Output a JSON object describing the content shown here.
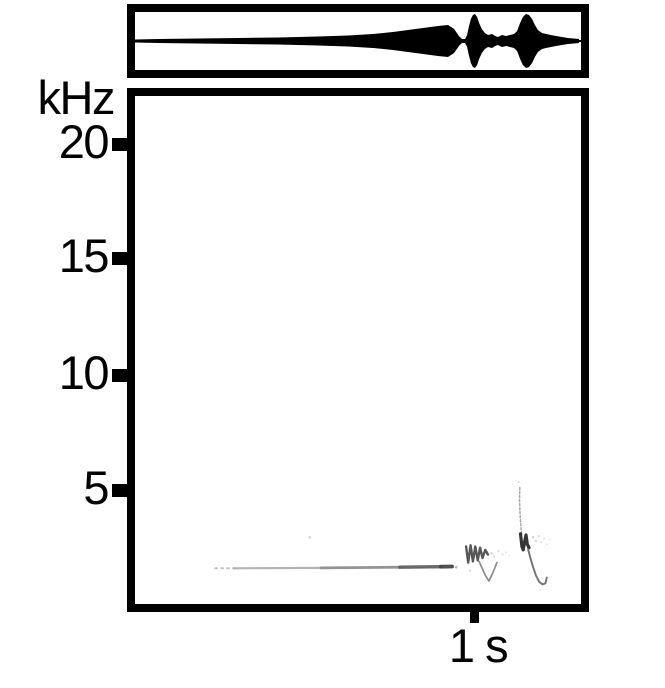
{
  "figure": {
    "description": "Sound figure: oscillogram (top) over spectrogram (bottom)",
    "background_color": "#ffffff",
    "frame_color": "#000000"
  },
  "axes": {
    "y_unit_label": "kHz",
    "y_tick_labels": [
      "20",
      "15",
      "10",
      "5"
    ],
    "x_tick_label": "1 s"
  },
  "chart_data": [
    {
      "type": "area",
      "title": "oscillogram (waveform amplitude envelope)",
      "x_unit": "s",
      "x_range": [
        0,
        1.3
      ],
      "t": [
        0,
        0.073,
        0.19,
        0.307,
        0.424,
        0.541,
        0.629,
        0.702,
        0.76,
        0.804,
        0.848,
        0.892,
        0.921,
        0.939,
        0.953,
        0.962,
        0.971,
        0.977,
        0.982,
        0.988,
        0.994,
        1.0,
        1.006,
        1.012,
        1.02,
        1.029,
        1.038,
        1.05,
        1.059,
        1.067,
        1.079,
        1.091,
        1.102,
        1.114,
        1.123,
        1.132,
        1.14,
        1.149,
        1.158,
        1.167,
        1.175,
        1.184,
        1.196,
        1.208,
        1.222,
        1.237,
        1.254,
        1.272,
        1.289,
        1.304
      ],
      "amplitude": [
        0.056,
        0.074,
        0.093,
        0.111,
        0.13,
        0.167,
        0.204,
        0.259,
        0.333,
        0.407,
        0.481,
        0.556,
        0.593,
        0.444,
        0.185,
        0.074,
        0.074,
        0.222,
        0.519,
        0.815,
        0.963,
        1.0,
        0.889,
        0.667,
        0.444,
        0.296,
        0.222,
        0.259,
        0.185,
        0.148,
        0.222,
        0.185,
        0.222,
        0.259,
        0.37,
        0.667,
        0.889,
        1.0,
        0.963,
        0.815,
        0.593,
        0.407,
        0.296,
        0.259,
        0.222,
        0.185,
        0.148,
        0.111,
        0.093,
        0.074
      ],
      "notes": "thin line fading in, crescendo swell peaking near t=0.92 s, then two loud call bursts at t=1.0 s and t=1.15 s with decaying tails"
    },
    {
      "type": "heatmap",
      "title": "spectrogram",
      "ylabel": "kHz",
      "y_ticks": [
        20,
        15,
        10,
        5
      ],
      "y_range": [
        0,
        22
      ],
      "x_range": [
        0,
        1.3
      ],
      "x_tick": {
        "label": "1 s",
        "t": 1.0
      },
      "grid": false,
      "traces": [
        {
          "name": "trill-start-dotted",
          "points": [
            [
              0.24,
              1.55
            ],
            [
              0.3,
              1.55
            ]
          ],
          "color": "#bcbcbc",
          "width": 2,
          "dash": "2,4",
          "opacity": 0.9
        },
        {
          "name": "trill-faint",
          "points": [
            [
              0.295,
              1.55
            ],
            [
              0.55,
              1.57
            ]
          ],
          "color": "#ababab",
          "width": 2.2,
          "opacity": 0.9
        },
        {
          "name": "trill-mid",
          "points": [
            [
              0.55,
              1.57
            ],
            [
              0.78,
              1.6
            ]
          ],
          "color": "#8d8d8d",
          "width": 2.8,
          "opacity": 0.95
        },
        {
          "name": "trill-strong",
          "points": [
            [
              0.78,
              1.6
            ],
            [
              0.9,
              1.62
            ]
          ],
          "color": "#606060",
          "width": 3.4,
          "opacity": 0.95
        },
        {
          "name": "trill-end",
          "points": [
            [
              0.9,
              1.62
            ],
            [
              0.933,
              1.63
            ]
          ],
          "color": "#474747",
          "width": 3.8,
          "opacity": 0.95
        },
        {
          "name": "note1-wavy",
          "points": [
            [
              0.974,
              2.5
            ],
            [
              0.98,
              1.8
            ],
            [
              0.987,
              2.55
            ],
            [
              0.994,
              1.85
            ],
            [
              1.001,
              2.5
            ],
            [
              1.008,
              1.9
            ],
            [
              1.015,
              2.45
            ],
            [
              1.022,
              2.0
            ],
            [
              1.03,
              2.35
            ],
            [
              1.038,
              2.15
            ]
          ],
          "color": "#3a3a3a",
          "width": 2.4,
          "opacity": 0.85
        },
        {
          "name": "note1-descending-v",
          "points": [
            [
              1.012,
              1.85
            ],
            [
              1.03,
              1.25
            ],
            [
              1.041,
              1.0
            ],
            [
              1.052,
              1.35
            ],
            [
              1.064,
              1.8
            ]
          ],
          "color": "#6f6f6f",
          "width": 1.7,
          "opacity": 0.8
        },
        {
          "name": "note2-spike",
          "points": [
            [
              1.131,
              5.05
            ],
            [
              1.13,
              4.5
            ],
            [
              1.132,
              3.9
            ],
            [
              1.134,
              3.4
            ],
            [
              1.136,
              3.05
            ]
          ],
          "color": "#8a8a8a",
          "width": 1.5,
          "dash": "2,2",
          "opacity": 0.75
        },
        {
          "name": "note2-core",
          "points": [
            [
              1.133,
              3.05
            ],
            [
              1.137,
              2.5
            ],
            [
              1.141,
              2.35
            ],
            [
              1.145,
              2.7
            ],
            [
              1.149,
              3.0
            ],
            [
              1.153,
              2.6
            ],
            [
              1.158,
              2.45
            ]
          ],
          "color": "#202020",
          "width": 3.2,
          "opacity": 0.9
        },
        {
          "name": "note2-tail",
          "points": [
            [
              1.155,
              2.4
            ],
            [
              1.163,
              1.95
            ],
            [
              1.17,
              1.6
            ],
            [
              1.178,
              1.25
            ],
            [
              1.187,
              0.98
            ],
            [
              1.197,
              0.85
            ],
            [
              1.206,
              0.9
            ],
            [
              1.21,
              1.15
            ]
          ],
          "color": "#5a5a5a",
          "width": 1.9,
          "opacity": 0.85
        }
      ],
      "speckles": [
        [
          0.517,
          2.9,
          1.5,
          "#d9d9d9",
          0.9
        ],
        [
          0.945,
          1.6,
          1.3,
          "#9b9b9b",
          0.7
        ],
        [
          0.985,
          1.45,
          1.2,
          "#cfcfcf",
          0.8
        ],
        [
          1.048,
          2.2,
          1.1,
          "#aeaeae",
          0.6
        ],
        [
          1.056,
          2.05,
          1.1,
          "#b6b6b6",
          0.6
        ],
        [
          1.068,
          2.3,
          1.0,
          "#bebebe",
          0.6
        ],
        [
          1.08,
          2.15,
          1.0,
          "#c5c5c5",
          0.55
        ],
        [
          1.09,
          2.25,
          1.0,
          "#cccccc",
          0.5
        ],
        [
          1.1,
          2.1,
          0.9,
          "#d2d2d2",
          0.5
        ],
        [
          1.128,
          5.3,
          0.9,
          "#ababab",
          0.6
        ],
        [
          1.17,
          2.9,
          1.2,
          "#a9a9a9",
          0.6
        ],
        [
          1.178,
          2.75,
          1.2,
          "#b1b1b1",
          0.6
        ],
        [
          1.186,
          2.95,
          1.1,
          "#b5b5b5",
          0.55
        ],
        [
          1.194,
          2.7,
          1.1,
          "#b9b9b9",
          0.5
        ],
        [
          1.202,
          2.85,
          1.0,
          "#bdbdbd",
          0.5
        ],
        [
          1.21,
          2.6,
          1.0,
          "#c1c1c1",
          0.45
        ],
        [
          1.218,
          2.8,
          1.0,
          "#c6c6c6",
          0.4
        ],
        [
          1.19,
          0.6,
          1.0,
          "#cdcdcd",
          0.5
        ]
      ],
      "notes": "long nearly flat tonal band near 1.6 kHz from 0.24-0.93 s intensifying toward its end; call note 1 near 1.0 s (wavy mark 1.8-2.6 kHz with V dipping to 1.0 kHz); call note 2 near 1.15 s (chirp spike up to ~5 kHz, dark core ~2.4-3 kHz, hooked tail descending to ~0.85 kHz)"
    }
  ]
}
